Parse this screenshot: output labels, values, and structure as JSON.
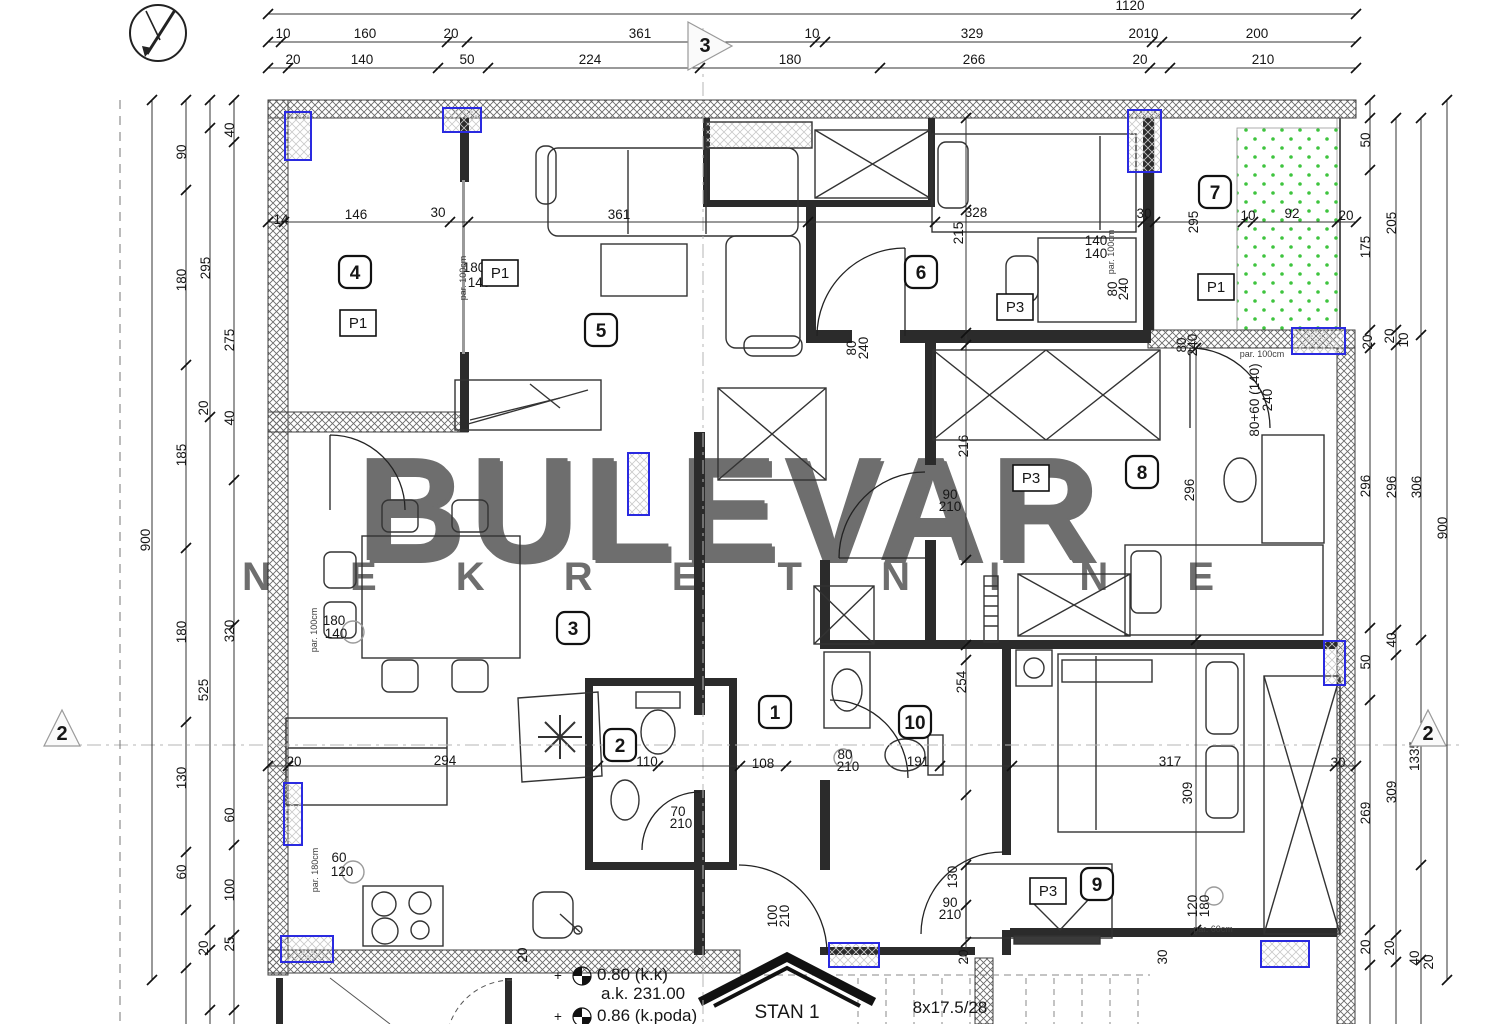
{
  "watermark": {
    "line1": "BULEVAR",
    "line2": "N E K R E T N I N E",
    "color": "#dcdcdc",
    "shadow": "#b9b9b9"
  },
  "footer": {
    "stan_label": "STAN 1",
    "stairs_label": "8x17.5/28",
    "levels": [
      {
        "t": "0.80 (k.k)",
        "x": 597,
        "y": 980
      },
      {
        "t": "a.k. 231.00",
        "x": 601,
        "y": 999
      },
      {
        "t": "0.86 (k.poda)",
        "x": 597,
        "y": 1021
      }
    ],
    "plus_marks": [
      {
        "x": 558,
        "y": 980
      },
      {
        "x": 558,
        "y": 1021
      }
    ]
  },
  "colors": {
    "blue": "#2a2ae0",
    "green": "#3ec43e",
    "wall": "#4a4a4a",
    "line": "#222222"
  },
  "rooms": [
    {
      "n": "1",
      "x": 775,
      "y": 712
    },
    {
      "n": "2",
      "x": 620,
      "y": 745
    },
    {
      "n": "3",
      "x": 573,
      "y": 628
    },
    {
      "n": "4",
      "x": 355,
      "y": 272
    },
    {
      "n": "5",
      "x": 601,
      "y": 330
    },
    {
      "n": "6",
      "x": 921,
      "y": 272
    },
    {
      "n": "7",
      "x": 1215,
      "y": 192
    },
    {
      "n": "8",
      "x": 1142,
      "y": 472
    },
    {
      "n": "9",
      "x": 1097,
      "y": 884
    },
    {
      "n": "10",
      "x": 915,
      "y": 722
    }
  ],
  "p_labels": [
    {
      "t": "P1",
      "x": 358,
      "y": 323
    },
    {
      "t": "P1",
      "x": 500,
      "y": 273
    },
    {
      "t": "P1",
      "x": 1216,
      "y": 287
    },
    {
      "t": "P3",
      "x": 1015,
      "y": 307
    },
    {
      "t": "P3",
      "x": 1031,
      "y": 478
    },
    {
      "t": "P3",
      "x": 1048,
      "y": 891
    }
  ],
  "section_markers": [
    {
      "t": "3",
      "x": 705,
      "y": 52,
      "pts": "688,22 688,70 732,46"
    },
    {
      "t": "2",
      "x": 62,
      "y": 740,
      "pts": "44,746 80,746 62,710"
    },
    {
      "t": "2",
      "x": 1428,
      "y": 740,
      "pts": "1410,746 1446,746 1428,710"
    }
  ],
  "dim_labels": [
    {
      "t": "1120",
      "x": 1130,
      "y": 10
    },
    {
      "t": "10",
      "x": 283,
      "y": 38
    },
    {
      "t": "160",
      "x": 365,
      "y": 38
    },
    {
      "t": "20",
      "x": 451,
      "y": 38
    },
    {
      "t": "361",
      "x": 640,
      "y": 38
    },
    {
      "t": "10",
      "x": 812,
      "y": 38
    },
    {
      "t": "329",
      "x": 972,
      "y": 38
    },
    {
      "t": "20",
      "x": 1136,
      "y": 38
    },
    {
      "t": "10",
      "x": 1151,
      "y": 38
    },
    {
      "t": "200",
      "x": 1257,
      "y": 38
    },
    {
      "t": "20",
      "x": 293,
      "y": 64
    },
    {
      "t": "140",
      "x": 362,
      "y": 64
    },
    {
      "t": "50",
      "x": 467,
      "y": 64
    },
    {
      "t": "224",
      "x": 590,
      "y": 64
    },
    {
      "t": "180",
      "x": 790,
      "y": 64
    },
    {
      "t": "266",
      "x": 974,
      "y": 64
    },
    {
      "t": "20",
      "x": 1140,
      "y": 64
    },
    {
      "t": "210",
      "x": 1263,
      "y": 64
    },
    {
      "t": "900",
      "x": 150,
      "y": 540,
      "r": 1
    },
    {
      "t": "90",
      "x": 186,
      "y": 152,
      "r": 1
    },
    {
      "t": "180",
      "x": 186,
      "y": 280,
      "r": 1
    },
    {
      "t": "185",
      "x": 186,
      "y": 455,
      "r": 1
    },
    {
      "t": "180",
      "x": 186,
      "y": 632,
      "r": 1
    },
    {
      "t": "130",
      "x": 186,
      "y": 778,
      "r": 1
    },
    {
      "t": "60",
      "x": 186,
      "y": 872,
      "r": 1
    },
    {
      "t": "295",
      "x": 210,
      "y": 268,
      "r": 1
    },
    {
      "t": "20",
      "x": 208,
      "y": 408,
      "r": 1
    },
    {
      "t": "525",
      "x": 208,
      "y": 690,
      "r": 1
    },
    {
      "t": "20",
      "x": 208,
      "y": 948,
      "r": 1
    },
    {
      "t": "40",
      "x": 234,
      "y": 130,
      "r": 1
    },
    {
      "t": "275",
      "x": 234,
      "y": 340,
      "r": 1
    },
    {
      "t": "40",
      "x": 234,
      "y": 418,
      "r": 1
    },
    {
      "t": "320",
      "x": 234,
      "y": 631,
      "r": 1
    },
    {
      "t": "60",
      "x": 234,
      "y": 815,
      "r": 1
    },
    {
      "t": "100",
      "x": 234,
      "y": 890,
      "r": 1
    },
    {
      "t": "25",
      "x": 234,
      "y": 944,
      "r": 1
    },
    {
      "t": "50",
      "x": 1370,
      "y": 140,
      "r": 1
    },
    {
      "t": "175",
      "x": 1370,
      "y": 247,
      "r": 1
    },
    {
      "t": "20",
      "x": 1372,
      "y": 342,
      "r": 1
    },
    {
      "t": "296",
      "x": 1370,
      "y": 486,
      "r": 1
    },
    {
      "t": "50",
      "x": 1370,
      "y": 662,
      "r": 1
    },
    {
      "t": "269",
      "x": 1370,
      "y": 813,
      "r": 1
    },
    {
      "t": "20",
      "x": 1370,
      "y": 947,
      "r": 1
    },
    {
      "t": "205",
      "x": 1396,
      "y": 223,
      "r": 1
    },
    {
      "t": "20",
      "x": 1394,
      "y": 336,
      "r": 1
    },
    {
      "t": "296",
      "x": 1396,
      "y": 487,
      "r": 1
    },
    {
      "t": "40",
      "x": 1396,
      "y": 640,
      "r": 1
    },
    {
      "t": "309",
      "x": 1396,
      "y": 792,
      "r": 1
    },
    {
      "t": "20",
      "x": 1394,
      "y": 948,
      "r": 1
    },
    {
      "t": "10",
      "x": 1408,
      "y": 340,
      "r": 1
    },
    {
      "t": "306",
      "x": 1421,
      "y": 487,
      "r": 1
    },
    {
      "t": "1335",
      "x": 1419,
      "y": 756,
      "r": 1
    },
    {
      "t": "40",
      "x": 1419,
      "y": 958,
      "r": 1
    },
    {
      "t": "20",
      "x": 1433,
      "y": 962,
      "r": 1
    },
    {
      "t": "900",
      "x": 1447,
      "y": 528,
      "r": 1
    },
    {
      "t": "14",
      "x": 281,
      "y": 224
    },
    {
      "t": "146",
      "x": 356,
      "y": 219
    },
    {
      "t": "30",
      "x": 438,
      "y": 217
    },
    {
      "t": "361",
      "x": 619,
      "y": 219
    },
    {
      "t": "328",
      "x": 976,
      "y": 217
    },
    {
      "t": "30",
      "x": 1144,
      "y": 218
    },
    {
      "t": "10",
      "x": 1248,
      "y": 220
    },
    {
      "t": "92",
      "x": 1292,
      "y": 218
    },
    {
      "t": "20",
      "x": 1346,
      "y": 220
    },
    {
      "t": "215",
      "x": 963,
      "y": 233,
      "r": 1
    },
    {
      "t": "295",
      "x": 1198,
      "y": 222,
      "r": 1
    },
    {
      "t": "140",
      "x": 1096,
      "y": 245
    },
    {
      "t": "140",
      "x": 1096,
      "y": 258
    },
    {
      "t": "180",
      "x": 474,
      "y": 272
    },
    {
      "t": "140",
      "x": 479,
      "y": 287
    },
    {
      "t": "80",
      "x": 856,
      "y": 348,
      "r": 1
    },
    {
      "t": "240",
      "x": 868,
      "y": 348,
      "r": 1
    },
    {
      "t": "80",
      "x": 1117,
      "y": 289,
      "r": 1
    },
    {
      "t": "240",
      "x": 1128,
      "y": 289,
      "r": 1
    },
    {
      "t": "80",
      "x": 1186,
      "y": 345,
      "r": 1
    },
    {
      "t": "240",
      "x": 1197,
      "y": 345,
      "r": 1
    },
    {
      "t": "90",
      "x": 950,
      "y": 499
    },
    {
      "t": "210",
      "x": 950,
      "y": 511
    },
    {
      "t": "216",
      "x": 968,
      "y": 446,
      "r": 1
    },
    {
      "t": "296",
      "x": 1194,
      "y": 490,
      "r": 1
    },
    {
      "t": "80+60 (140)",
      "x": 1259,
      "y": 400,
      "r": 1
    },
    {
      "t": "240",
      "x": 1272,
      "y": 400,
      "r": 1
    },
    {
      "t": "180",
      "x": 334,
      "y": 625
    },
    {
      "t": "140",
      "x": 336,
      "y": 638
    },
    {
      "t": "20",
      "x": 294,
      "y": 766
    },
    {
      "t": "294",
      "x": 445,
      "y": 765
    },
    {
      "t": "110",
      "x": 647,
      "y": 766
    },
    {
      "t": "70",
      "x": 678,
      "y": 816
    },
    {
      "t": "210",
      "x": 681,
      "y": 828
    },
    {
      "t": "108",
      "x": 763,
      "y": 768
    },
    {
      "t": "80",
      "x": 845,
      "y": 759
    },
    {
      "t": "210",
      "x": 848,
      "y": 771
    },
    {
      "t": "191",
      "x": 918,
      "y": 766
    },
    {
      "t": "317",
      "x": 1170,
      "y": 766
    },
    {
      "t": "30",
      "x": 1338,
      "y": 767
    },
    {
      "t": "254",
      "x": 966,
      "y": 682,
      "r": 1
    },
    {
      "t": "309",
      "x": 1192,
      "y": 793,
      "r": 1
    },
    {
      "t": "60",
      "x": 339,
      "y": 862
    },
    {
      "t": "120",
      "x": 342,
      "y": 876
    },
    {
      "t": "130",
      "x": 957,
      "y": 877,
      "r": 1
    },
    {
      "t": "90",
      "x": 950,
      "y": 907
    },
    {
      "t": "210",
      "x": 950,
      "y": 919
    },
    {
      "t": "100",
      "x": 777,
      "y": 916,
      "r": 1
    },
    {
      "t": "210",
      "x": 789,
      "y": 916,
      "r": 1
    },
    {
      "t": "20",
      "x": 527,
      "y": 955,
      "r": 1
    },
    {
      "t": "20",
      "x": 968,
      "y": 957,
      "r": 1
    },
    {
      "t": "30",
      "x": 1167,
      "y": 957,
      "r": 1
    },
    {
      "t": "120",
      "x": 1197,
      "y": 906,
      "r": 1
    },
    {
      "t": "180",
      "x": 1209,
      "y": 906,
      "r": 1
    },
    {
      "t": "+",
      "x": 558,
      "y": 980
    },
    {
      "t": "+",
      "x": 558,
      "y": 1021
    }
  ],
  "annotations": [
    {
      "t": "par. 100cm",
      "x": 466,
      "y": 278,
      "r": 1
    },
    {
      "t": "par. 100cm",
      "x": 1114,
      "y": 252,
      "r": 1
    },
    {
      "t": "par. 100cm",
      "x": 1262,
      "y": 357
    },
    {
      "t": "par. 100cm",
      "x": 317,
      "y": 630,
      "r": 1
    },
    {
      "t": "par. 180cm",
      "x": 318,
      "y": 870,
      "r": 1
    },
    {
      "t": "par. 60cm",
      "x": 1213,
      "y": 932
    }
  ],
  "chains": {
    "h": [
      {
        "y": 14,
        "x1": 268,
        "x2": 1356,
        "ticks": [
          268,
          1356
        ]
      },
      {
        "y": 42,
        "x1": 268,
        "x2": 1356,
        "ticks": [
          268,
          281,
          447,
          467,
          815,
          825,
          1152,
          1162,
          1356
        ]
      },
      {
        "y": 68,
        "x1": 268,
        "x2": 1356,
        "ticks": [
          268,
          288,
          438,
          488,
          700,
          880,
          1150,
          1170,
          1356
        ]
      },
      {
        "y": 222,
        "x1": 268,
        "x2": 1356,
        "ticks": [
          268,
          284,
          450,
          468,
          808,
          935,
          1143,
          1155,
          1243,
          1253,
          1337,
          1356
        ]
      },
      {
        "y": 766,
        "x1": 268,
        "x2": 1356,
        "ticks": [
          268,
          288,
          598,
          658,
          740,
          786,
          940,
          1012,
          1335,
          1356
        ]
      }
    ],
    "v": [
      {
        "x": 152,
        "y1": 100,
        "y2": 980,
        "ticks": [
          100,
          980
        ]
      },
      {
        "x": 186,
        "y1": 100,
        "y2": 1024,
        "ticks": [
          100,
          190,
          365,
          548,
          722,
          852,
          910,
          968
        ]
      },
      {
        "x": 210,
        "y1": 100,
        "y2": 1024,
        "ticks": [
          100,
          128,
          417,
          930,
          950,
          1010
        ]
      },
      {
        "x": 234,
        "y1": 100,
        "y2": 1024,
        "ticks": [
          100,
          142,
          480,
          625,
          845,
          935,
          1010
        ]
      },
      {
        "x": 1370,
        "y1": 100,
        "y2": 1024,
        "ticks": [
          100,
          118,
          170,
          330,
          348,
          628,
          700,
          930,
          965
        ]
      },
      {
        "x": 1396,
        "y1": 118,
        "y2": 1024,
        "ticks": [
          118,
          330,
          345,
          630,
          655,
          935,
          962
        ]
      },
      {
        "x": 1421,
        "y1": 118,
        "y2": 1024,
        "ticks": [
          118,
          335,
          640,
          865,
          960
        ]
      },
      {
        "x": 1447,
        "y1": 100,
        "y2": 980,
        "ticks": [
          100,
          980
        ]
      },
      {
        "x": 966,
        "y1": 118,
        "y2": 960,
        "ticks": [
          118,
          210,
          333,
          345,
          560,
          645,
          660,
          795,
          865,
          905,
          942
        ]
      },
      {
        "x": 1196,
        "y1": 348,
        "y2": 935,
        "ticks": [
          348,
          640,
          930
        ]
      }
    ]
  }
}
